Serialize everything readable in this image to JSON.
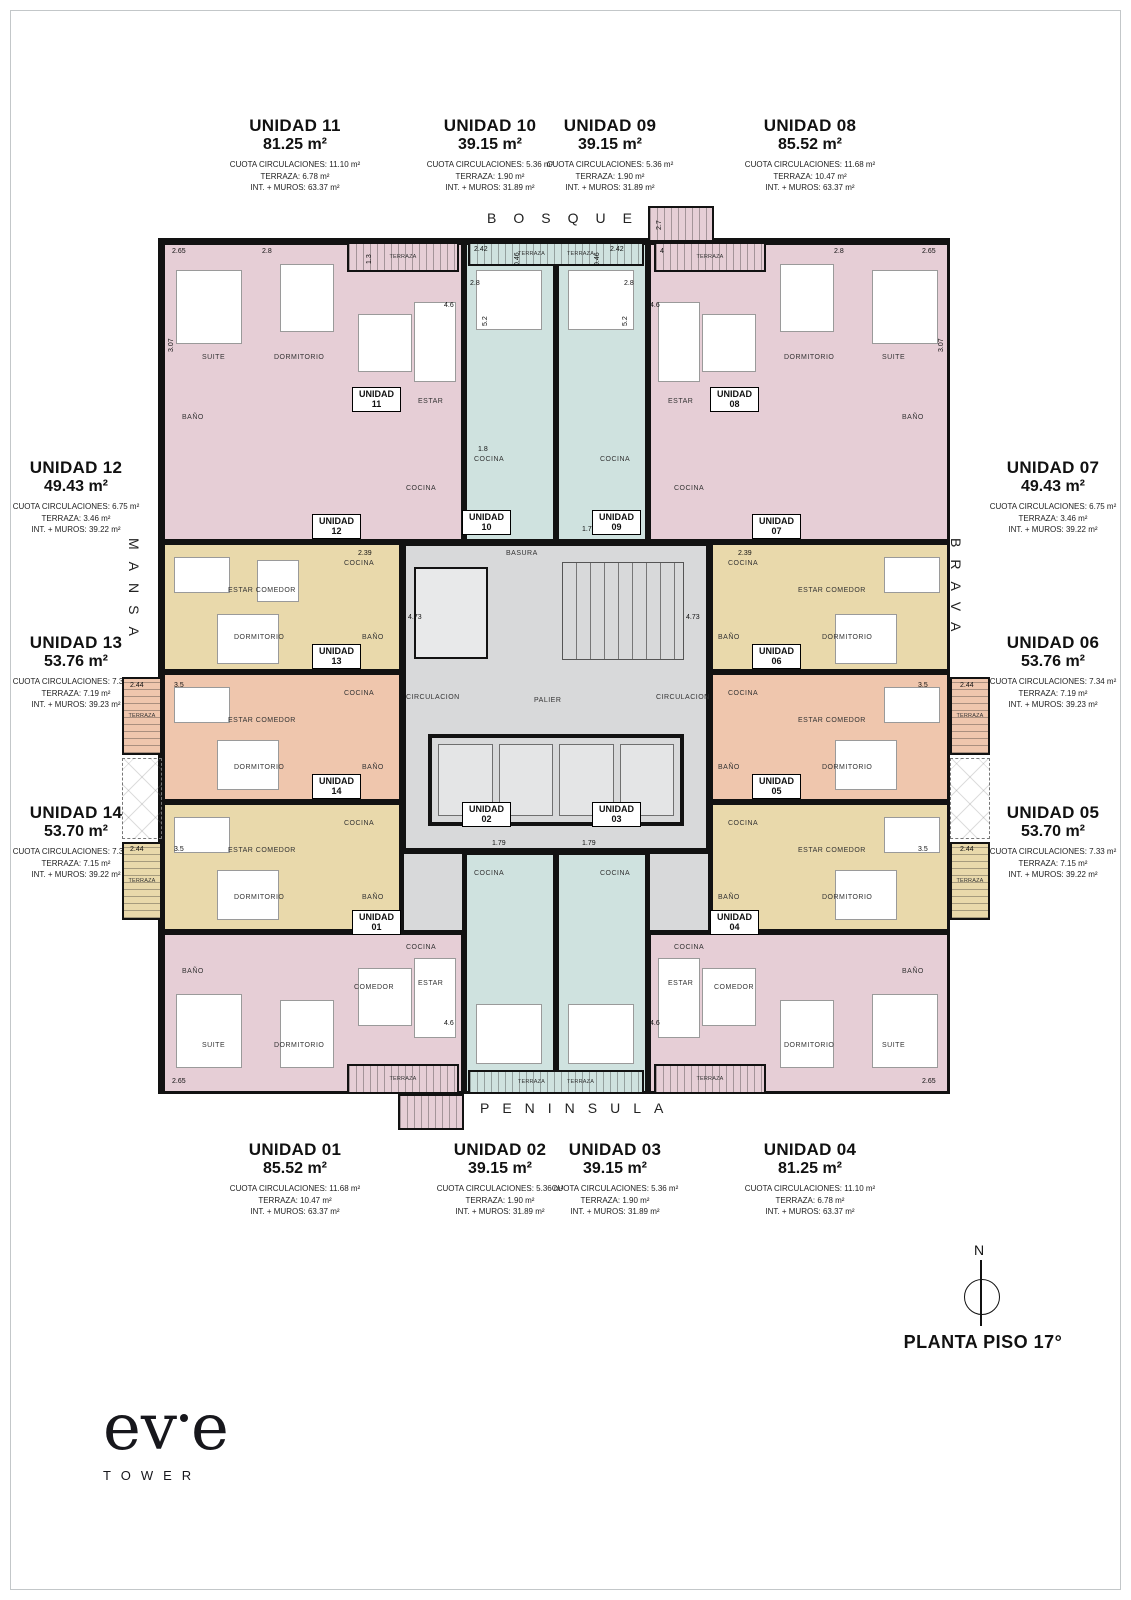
{
  "title": "PLANTA PISO 17°",
  "compass": {
    "north": "N"
  },
  "logo": {
    "p1": "ev",
    "p2": "e",
    "sub": "TOWER"
  },
  "streets": {
    "top": "BOSQUE",
    "bottom": "PENINSULA",
    "left": "MANSA",
    "right": "BRAVA"
  },
  "unit_labels": [
    {
      "name": "UNIDAD 11",
      "area": "81.25 m²",
      "l1": "CUOTA CIRCULACIONES: 11.10 m²",
      "l2": "TERRAZA: 6.78 m²",
      "l3": "INT. + MUROS: 63.37 m²"
    },
    {
      "name": "UNIDAD 10",
      "area": "39.15 m²",
      "l1": "CUOTA CIRCULACIONES: 5.36 m²",
      "l2": "TERRAZA: 1.90 m²",
      "l3": "INT. + MUROS: 31.89 m²"
    },
    {
      "name": "UNIDAD 09",
      "area": "39.15 m²",
      "l1": "CUOTA CIRCULACIONES: 5.36 m²",
      "l2": "TERRAZA: 1.90 m²",
      "l3": "INT. + MUROS: 31.89 m²"
    },
    {
      "name": "UNIDAD 08",
      "area": "85.52 m²",
      "l1": "CUOTA CIRCULACIONES: 11.68 m²",
      "l2": "TERRAZA: 10.47 m²",
      "l3": "INT. + MUROS: 63.37 m²"
    },
    {
      "name": "UNIDAD 12",
      "area": "49.43 m²",
      "l1": "CUOTA CIRCULACIONES: 6.75 m²",
      "l2": "TERRAZA: 3.46 m²",
      "l3": "INT. + MUROS: 39.22 m²"
    },
    {
      "name": "UNIDAD 13",
      "area": "53.76 m²",
      "l1": "CUOTA CIRCULACIONES: 7.34 m²",
      "l2": "TERRAZA: 7.19 m²",
      "l3": "INT. + MUROS: 39.23 m²"
    },
    {
      "name": "UNIDAD 14",
      "area": "53.70 m²",
      "l1": "CUOTA CIRCULACIONES: 7.33 m²",
      "l2": "TERRAZA: 7.15 m²",
      "l3": "INT. + MUROS: 39.22 m²"
    },
    {
      "name": "UNIDAD 07",
      "area": "49.43 m²",
      "l1": "CUOTA CIRCULACIONES: 6.75 m²",
      "l2": "TERRAZA: 3.46 m²",
      "l3": "INT. + MUROS: 39.22 m²"
    },
    {
      "name": "UNIDAD 06",
      "area": "53.76 m²",
      "l1": "CUOTA CIRCULACIONES: 7.34 m²",
      "l2": "TERRAZA: 7.19 m²",
      "l3": "INT. + MUROS: 39.23 m²"
    },
    {
      "name": "UNIDAD 05",
      "area": "53.70 m²",
      "l1": "CUOTA CIRCULACIONES: 7.33 m²",
      "l2": "TERRAZA: 7.15 m²",
      "l3": "INT. + MUROS: 39.22 m²"
    },
    {
      "name": "UNIDAD 01",
      "area": "85.52 m²",
      "l1": "CUOTA CIRCULACIONES: 11.68 m²",
      "l2": "TERRAZA: 10.47 m²",
      "l3": "INT. + MUROS: 63.37 m²"
    },
    {
      "name": "UNIDAD 02",
      "area": "39.15 m²",
      "l1": "CUOTA CIRCULACIONES: 5.36 m²",
      "l2": "TERRAZA: 1.90 m²",
      "l3": "INT. + MUROS: 31.89 m²"
    },
    {
      "name": "UNIDAD 03",
      "area": "39.15 m²",
      "l1": "CUOTA CIRCULACIONES: 5.36 m²",
      "l2": "TERRAZA: 1.90 m²",
      "l3": "INT. + MUROS: 31.89 m²"
    },
    {
      "name": "UNIDAD 04",
      "area": "81.25 m²",
      "l1": "CUOTA CIRCULACIONES: 11.10 m²",
      "l2": "TERRAZA: 6.78 m²",
      "l3": "INT. + MUROS: 63.37 m²"
    }
  ],
  "plan": {
    "room_names": {
      "unidad": "UNIDAD",
      "suite": "SUITE",
      "dormitorio": "DORMITORIO",
      "comedor": "COMEDOR",
      "estar": "ESTAR",
      "estar_comedor": "ESTAR COMEDOR",
      "cocina": "COCINA",
      "bano": "BAÑO",
      "terraza": "TERRAZA",
      "circulacion": "CIRCULACION",
      "palier": "PALIER",
      "basura": "BASURA"
    },
    "tags": {
      "u01": "01",
      "u02": "02",
      "u03": "03",
      "u04": "04",
      "u05": "05",
      "u06": "06",
      "u07": "07",
      "u08": "08",
      "u09": "09",
      "u10": "10",
      "u11": "11",
      "u12": "12",
      "u13": "13",
      "u14": "14"
    },
    "dims": {
      "d265": "2.65",
      "d28": "2.8",
      "d13": "1.3",
      "d242": "2.42",
      "d046": "0.46",
      "d4": "4",
      "d27": "2.7",
      "d307": "3.07",
      "d46": "4.6",
      "d52": "5.2",
      "d244": "2.44",
      "d35": "3.5",
      "d179": "1.79",
      "d18": "1.8",
      "d239": "2.39",
      "d473": "4.73"
    },
    "colors": {
      "pink": "#e6ced6",
      "teal": "#cfe2df",
      "cream": "#e9d9ab",
      "salmon": "#efc6ad",
      "core_gray": "#d8d9da",
      "wall": "#121212"
    }
  }
}
